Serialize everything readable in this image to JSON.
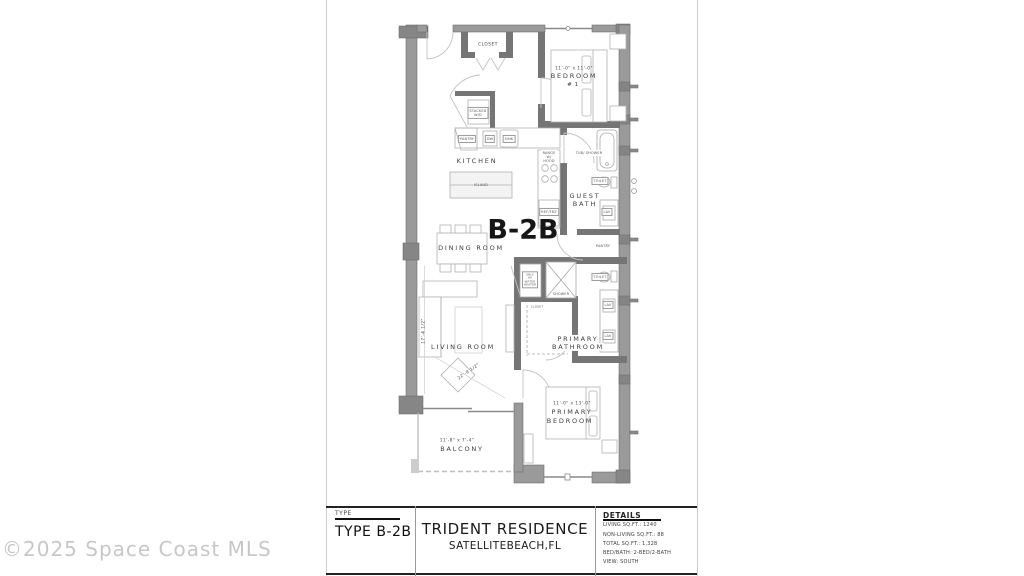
{
  "watermark": "©2025 Space Coast MLS",
  "plan": {
    "unit_label": "B-2B",
    "rooms": {
      "entry_closet": "CLOSET",
      "bedroom1": {
        "dims": "11'-0\" x 11'-0\"",
        "name": "BEDROOM",
        "num": "# 1"
      },
      "kitchen": "KITCHEN",
      "dining": "DINING ROOM",
      "living": "LIVING ROOM",
      "guest_bath": {
        "l1": "GUEST",
        "l2": "BATH"
      },
      "primary_bath": {
        "l1": "PRIMARY",
        "l2": "BATHROOM"
      },
      "primary_bedroom": {
        "dims": "11'-0\" x 13'-0\"",
        "l1": "PRIMARY",
        "l2": "BEDROOM"
      },
      "balcony": {
        "dims": "11'-8\" x 7'-4\"",
        "name": "BALCONY"
      },
      "walkin_closet": "CLOSET"
    },
    "fixtures": {
      "stacked_wd": "STACKED W/D",
      "pantry_kitchen": "PANTRY",
      "dw": "DW",
      "sink": "SINK",
      "island": "ISLAND",
      "range": "RANGE W/ HOOD",
      "ref": "REF/FRZ",
      "tub_shower": "TUB/ SHOWER",
      "toilet_guest": "TOILET",
      "lav_guest": "LAV",
      "pantry_hall": "PANTRY",
      "water_heater": "SHLV W/ WATER HEATER",
      "shower": "SHOWER",
      "toilet_primary": "TOILET",
      "lav1": "LAV",
      "lav2": "LAV"
    },
    "dims": {
      "living_diag": "22'-9 1/2\"",
      "living_vert": "17'-4 1/2\""
    }
  },
  "title_block": {
    "type_label": "TYPE",
    "type_value": "TYPE B-2B",
    "project_name": "TRIDENT RESIDENCE",
    "project_location": "SATELLITEBEACH,FL",
    "details_label": "DETAILS",
    "details": [
      "LIVING SQ.FT.: 1240",
      "NON-LIVING SQ.FT.: 88",
      "TOTAL SQ.FT.: 1,328",
      "BED/BATH: 2-BED/2-BATH",
      "VIEW: SOUTH"
    ]
  }
}
